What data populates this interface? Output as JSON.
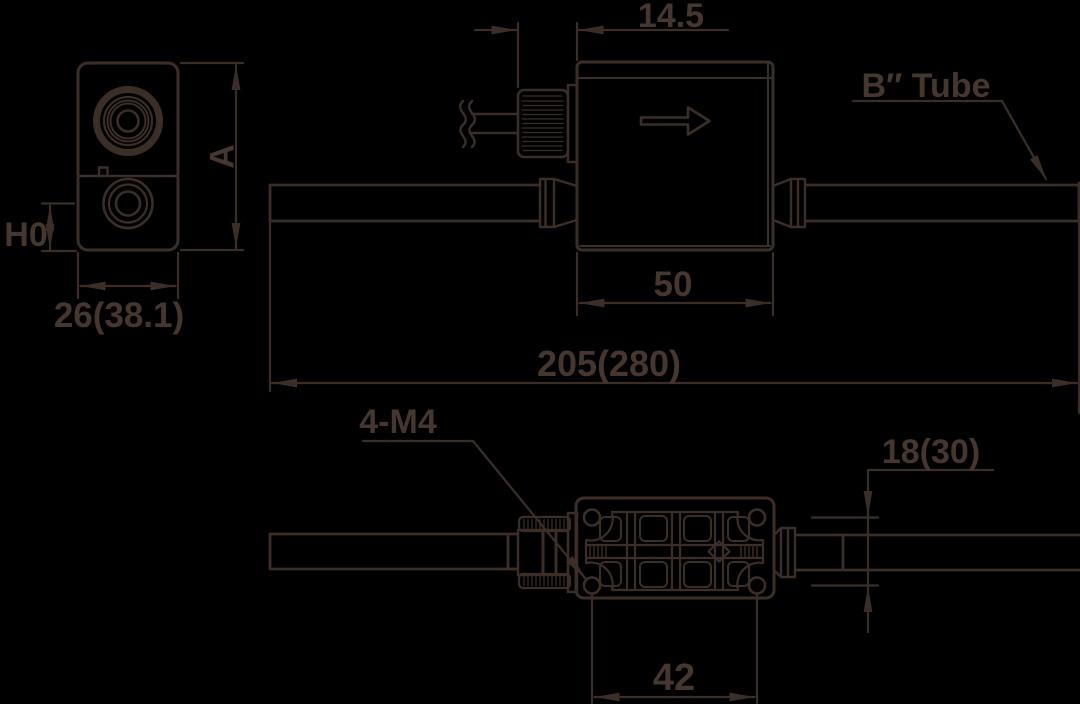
{
  "drawing": {
    "type": "technical-dimension-drawing",
    "colors": {
      "background": "#000000",
      "line": "#3b2e27",
      "text": "#45372e"
    },
    "views": {
      "front": {
        "height": "A",
        "port_center_height": "H0",
        "width": "26(38.1)"
      },
      "side": {
        "connector_offset": "14.5",
        "tube": "B″ Tube",
        "body_length": "50",
        "overall_length": "205(280)"
      },
      "bottom": {
        "mounting_thread": "4-M4",
        "tube_center_offset": "18(30)",
        "mounting_pitch": "42"
      }
    }
  }
}
